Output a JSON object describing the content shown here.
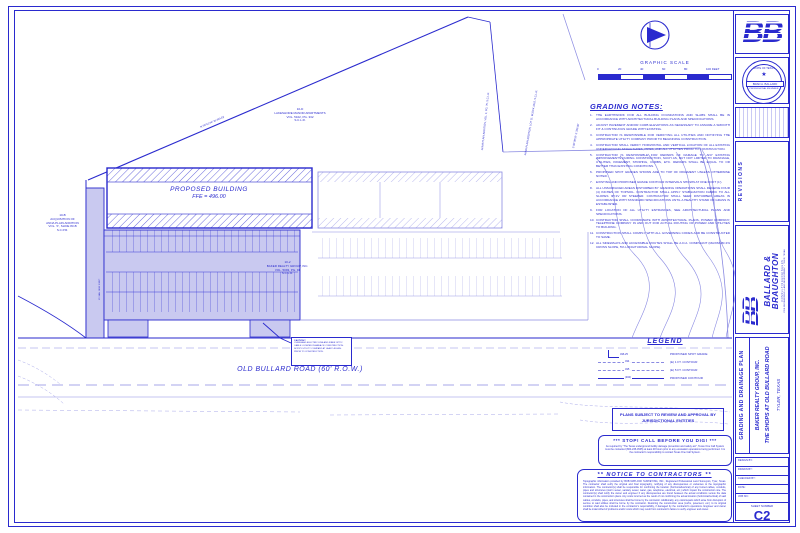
{
  "colors": {
    "ink": "#2a2ace",
    "ink_light": "#8a8ae2",
    "parking_fill": "#c9c9f0"
  },
  "plan": {
    "building_label": "PROPOSED BUILDING",
    "building_ffe": "FFE = 496.00",
    "road_label": "OLD BULLARD ROAD (60' R.O.W.)",
    "apartments": [
      "10-D",
      "LAKESHORE MANOR APARTMENTS",
      "VOL. 5102, PG. 332",
      "S.C.L.R."
    ],
    "parcel_main": [
      "10-2",
      "BAKER REALTY GROUP, INC.",
      "VOL. 5093, PG. 91",
      "S.C.L.R."
    ],
    "parcel_b": [
      "10-B",
      "ACQUISITION OF",
      "ANNA PLAIN ADDITION",
      "VOL. 'F', SLIDE 83-B",
      "S.C.P.R."
    ],
    "boundary_labels": [
      "N 59°51'44\" W  494.62'",
      "ANNA PLAIN ADDITION, VOL. 4, PG. 75, S.C.L.R.",
      "ANNA PLAIN ADDITION, LOT 'D', BLOCK 1010, S.C.L.R.",
      "S 00°08'16\" E  330.00'",
      "15' SAN. SEW. ESMT."
    ],
    "caution_title": "CAUTION!!",
    "caution_body": "OVERHEAD ELECTRIC LINE AND FIBER OPTIC CABLE LOCATED IN AREA OF CONSTRUCTION. NOTIFY UTILITY COMPANY AT LEAST 48 HRS. PRIOR TO CONSTRUCTION."
  },
  "graphic_scale": {
    "title": "GRAPHIC SCALE",
    "labels": [
      "0",
      "20",
      "40",
      "60",
      "80",
      "100 FEET"
    ]
  },
  "grading_notes": {
    "title": "GRADING NOTES:",
    "items": [
      {
        "num": "1.",
        "text": "THE EARTHWORK FOR ALL BUILDING FOUNDATIONS AND SLABS SHALL BE IN ACCORDANCE WITH ARCHITECTURAL BUILDING PLANS AND SPECIFICATIONS."
      },
      {
        "num": "2.",
        "text": "ADJUST PAVEMENT AND/OR CURB ELEVATIONS AS NECESSARY TO ASSURE A SMOOTH FIT & CONTINUOUS GRADE WITH EXISTING."
      },
      {
        "num": "3.",
        "text": "CONTRACTOR IS RESPONSIBLE FOR VERIFYING ALL UTILITIES AND NOTIFYING THE APPROPRIATE UTILITY COMPANY PRIOR TO BEGINNING CONSTRUCTION."
      },
      {
        "num": "4.",
        "text": "CONTRACTOR SHALL VERIFY HORIZONTAL AND VERTICAL LOCATION OF ALL EXISTING UNDERGROUND STRUCTURES, PIPES, AND ALL UTILITIES PRIOR TO CONSTRUCTION."
      },
      {
        "num": "5.",
        "text": "CONTRACTOR IS RESPONSIBLE FOR REPAIRS OF DAMAGE TO ANY EXISTING IMPROVEMENTS DURING CONSTRUCTION, SUCH AS, BUT NOT LIMITED TO DRAINAGE, UTILITIES, PAVEMENT, STRIPING, CURBS, ETC. REPAIRS SHALL BE EQUAL TO OR BETTER THAN EXISTING CONDITIONS."
      },
      {
        "num": "6.",
        "text": "PROPOSED SPOT GRADES SHOWN ARE TO TOP OF PAVEMENT UNLESS OTHERWISE NOTED."
      },
      {
        "num": "7.",
        "text": "EXISTING AND PROPOSED GRADE CONTOUR INTERVALS SHOWN AT ONE FOOT (1')."
      },
      {
        "num": "8.",
        "text": "ALL UNSURFACED AREAS DISTURBED BY GRADING OPERATIONS SHALL RECEIVE FOUR (4) INCHES OF TOPSOIL. CONTRACTOR SHALL APPLY STABILIZATION FABRIC TO ALL SLOPES 3H:1V OR STEEPER. CONTRACTOR SHALL SEED DISTURBED AREAS IN ACCORDANCE WITH STANDARD SPECIFICATIONS UNTIL A HEALTHY STAND OF GRASS IS ESTABLISHED."
      },
      {
        "num": "9.",
        "text": "FOR LOCATION OF ALL UTILITY ENTRANCES, SEE ARCHITECTURAL PLANS AND SPECIFICATIONS."
      },
      {
        "num": "10.",
        "text": "CONTRACTOR SHALL COORDINATE WITH ARCHITECTURAL PLANS, POWER COMPANY, TELEPHONE COMPANY IN AND OUT FOR ACTUAL ROUTING OF POWER AND UTILITIES TO BUILDING."
      },
      {
        "num": "11.",
        "text": "CONSTRUCTION SHALL COMPLY WITH ALL GOVERNING CODES AND BE CONSTRUCTED TO SAME."
      },
      {
        "num": "12.",
        "text": "ALL SIDEWALKS AND ACCESSIBLE ROUTES SHALL BE A.D.A. COMPLIANT (MAXIMUM 2% CROSS SLOPE, 5% LONGITUDINAL SLOPE)."
      }
    ]
  },
  "legend": {
    "title": "LEGEND",
    "items": [
      {
        "tag": "496.25",
        "label": "PROPOSED SPOT GRADE"
      },
      {
        "tag": "494",
        "label": "(E) 1 FT. CONTOUR"
      },
      {
        "tag": "495",
        "label": "(E) 5 FT. CONTOUR"
      },
      {
        "tag": "(490)",
        "label": "PROPOSED CONTOUR"
      }
    ]
  },
  "notices": {
    "plans_box": "PLANS SUBJECT TO REVIEW AND APPROVAL BY JURISDICTIONAL ENTITIES",
    "stop_title": "***   STOP!  CALL BEFORE YOU DIG!   ***",
    "stop_body": "As required by \"The Texas underground facility damage prevention and safety act\", Texas One Call System must be contacted (800-245-4545) at least 48 hours prior to any excavation operations being performed. It is the contractor's responsibility to contact Texas One Call System.",
    "notice_title": "**   NOTICE  TO  CONTRACTORS   **",
    "notice_body": "Topographic information provided by BOB MATLOCK SURVEYING, INC., Registered Professional Land Surveyors, Tyler, Texas. The contractor shall verify the original and final topography, notifying of any discrepancies or variances to the topographic information. The contractor(s) shall be responsible for confirming the location (horizontal/vertical) of any buried cables, conduits, pipes and structures (storm sewer, sanitary sewer, water, gas, telephone, electrical, etc.) which impact the construction site. The contractor(s) shall notify the owner and engineer if any discrepancies are found between the actual conditions versus the data contained in the construction plans. Any costs incurred as the result of not confirming the actual location (horizontal/vertical) of said cables, conduits, pipes, and structures shall be borne by the contractor. Additionally, any costs/repairs which arise from disruption of service to said utilities shall be borne by the contractor. Restoring the construction area (curbs, pavement, etc.) to its original condition shall also be included in the contractor's responsibility, if damaged by the contractor's operations. Engineer and owner shall be indemnified of problems and/or costs which may result from contractor's failure to verify engineer and owner."
  },
  "title_block": {
    "logo": "BB",
    "seal": {
      "state": "STATE OF TEXAS",
      "star": "★",
      "name": "BRAD A. BALLARD",
      "title": "PROFESSIONAL ENGINEER"
    },
    "revisions_title": "REVISIONS",
    "firm": {
      "name1": "BALLARD &",
      "name2": "BRAUGHTON",
      "tagline": "C O N S U L T I N G   E N G I N E E R S",
      "address": "CIVIL ENGINEERING • LAND DEVELOPMENT • TYLER, TEXAS"
    },
    "sheet_title": "GRADING AND DRAINAGE PLAN",
    "client": "BAKER REALTY GROUP, INC.",
    "project": "THE SHOPS AT OLD BULLARD ROAD",
    "location": "TYLER, TEXAS",
    "info_labels": [
      "DESIGN BY:",
      "DRAWN BY:",
      "CHECKED BY:",
      "DATE:",
      "JOB NO.:"
    ],
    "sheet_number_label": "SHEET NUMBER",
    "sheet_number": "C2"
  }
}
